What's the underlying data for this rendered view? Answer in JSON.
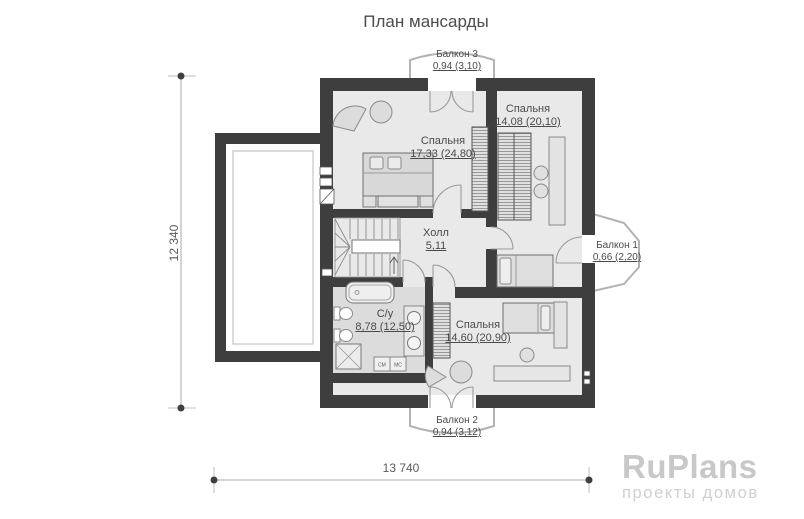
{
  "title": "План мансарды",
  "plan": {
    "rooms": {
      "bedroom1": {
        "name": "Спальня",
        "area": "17,33 (24,80)"
      },
      "bedroom2": {
        "name": "Спальня",
        "area": "14,08 (20,10)"
      },
      "hall": {
        "name": "Холл",
        "area": "5,11"
      },
      "bathroom": {
        "name": "С/у",
        "area": "8,78 (12,50)"
      },
      "bedroom3": {
        "name": "Спальня",
        "area": "14,60 (20,90)"
      }
    },
    "balconies": {
      "balcony1": {
        "name": "Балкон 1",
        "area": "0,66 (2,20)"
      },
      "balcony2": {
        "name": "Балкон 2",
        "area": "0,94 (3,12)"
      },
      "balcony3": {
        "name": "Балкон 3",
        "area": "0,94 (3,10)"
      }
    },
    "appliances": {
      "washer": "СМ",
      "dryer": "МС"
    }
  },
  "dimensions": {
    "height": "12 340",
    "width": "13 740"
  },
  "branding": {
    "logo": "RuPlans",
    "tagline": "проекты домов"
  },
  "colors": {
    "wall": "#3e3e3e",
    "floor": "#e9e9e9",
    "bathroom_floor": "#dcdcdc",
    "thin_line": "#9a9a9a",
    "text": "#4a4a4a",
    "logo_gray": "#c8c8c8"
  }
}
